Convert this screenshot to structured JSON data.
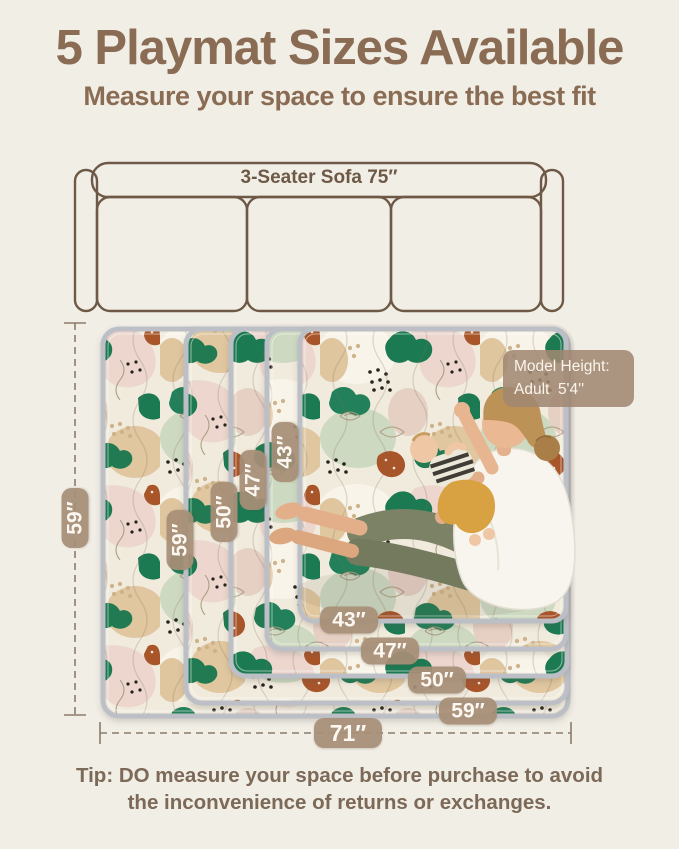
{
  "header": {
    "title": "5 Playmat Sizes Available",
    "subtitle": "Measure your space to ensure the best fit"
  },
  "sofa": {
    "label": "3-Seater Sofa 75″"
  },
  "model_badge": {
    "line1": "Model Height:",
    "line2": "Adult  5'4''"
  },
  "dimensions": {
    "mat_height_overall": "59″",
    "mat_width_overall": "71″",
    "stacked_mat_heights": [
      "59″",
      "50″",
      "47″",
      "43″"
    ],
    "stacked_mat_widths": [
      "43″",
      "47″",
      "50″",
      "59″"
    ]
  },
  "tip": "Tip: DO measure your space before purchase to avoid the inconvenience of returns or exchanges.",
  "colors": {
    "background": "#f1eee6",
    "heading_brown": "#8a6c54",
    "sofa_outline": "#6e5946",
    "label_pill_taupe": "#a78e76",
    "dimension_line": "#8d7c69",
    "mat_binding_gray": "#bcc0c6",
    "leaf_green": "#1f7a52",
    "terracotta": "#a9552c",
    "sand_tan": "#dfc69f",
    "blush_pink": "#ecd6ce",
    "sage_green": "#cdd9c1",
    "shirt_white": "#f7f5ee",
    "pants_olive": "#7c8265",
    "baby_pants_mustard": "#d8a242"
  }
}
